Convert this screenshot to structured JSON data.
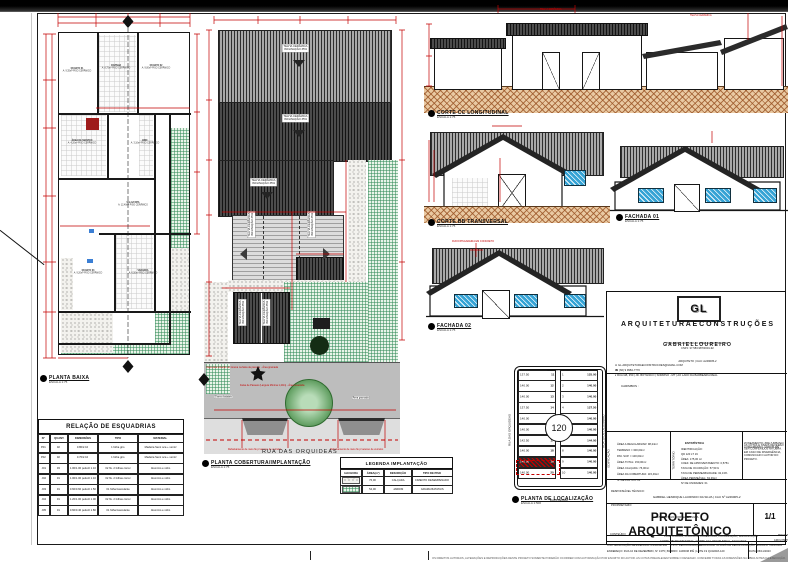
{
  "drawings": {
    "planta_baixa": {
      "label": "PLANTA BAIXA",
      "scale": "ESCALA  1:75"
    },
    "planta_cobertura": {
      "label": "PLANTA COBERTURA/IMPLANTAÇÃO",
      "scale": "ESCALA  1:75"
    },
    "planta_localizacao": {
      "label": "PLANTA DE LOCALIZAÇÃO",
      "scale": "ESCALA  1:500"
    },
    "corte_cc": {
      "label": "CORTE CC LONGITUDINAL",
      "scale": "ESCALA  1:75"
    },
    "corte_bb": {
      "label": "CORTE BB TRANSVERSAL",
      "scale": "ESCALA  1:75"
    },
    "fachada_01": {
      "label": "FACHADA 01",
      "scale": "ESCALA  1:75"
    },
    "fachada_02": {
      "label": "FACHADA 02",
      "scale": "ESCALA  1:75"
    }
  },
  "floor_plan": {
    "rooms": [
      {
        "name": "QUARTO 01",
        "info": "A: 9,35m² PISO CERÂMICO"
      },
      {
        "name": "COZINHA",
        "info": "A: 8,75m² PISO CERÂMICO"
      },
      {
        "name": "QUARTO 02",
        "info": "A: 9,00m² PISO CERÂMICO"
      },
      {
        "name": "ÁREA DE SERVIÇO",
        "info": "A: 4,20m² PISO CERÂMICO"
      },
      {
        "name": "BWC",
        "info": "A: 3,10m² PISO CERÂMICO"
      },
      {
        "name": "SALA/COPA",
        "info": "A: 12,40m² PISO CERÂMICO"
      },
      {
        "name": "QUARTO 03",
        "info": "A: 9,20m² PISO CERÂMICO"
      },
      {
        "name": "VARANDA",
        "info": "A: 6,50m² PISO CERÂMICO"
      }
    ]
  },
  "roof": {
    "tile_note": "TELHA CERÂMICA",
    "slope_note": "INCLINAÇÃO 35%"
  },
  "sections": {
    "rufo_note": "RUFO/PINGADEIRA EM CONCRETO"
  },
  "implantacao": {
    "street": "RUA DAS ORQUIDEAS",
    "notes": [
      "Vaga para locação de Grama na faixa de passeio - Área gramada",
      "Faixa de Passeio (Largura Mínima 1,20m) - Área revestida",
      "Grama batatais",
      "Rebaixamento de meio fio p/ acesso de veículos",
      "Rebaixamento de meio fio p/ acesso de veículos",
      "Área gramada"
    ]
  },
  "esquadrias": {
    "title": "RELAÇÃO DE ESQUADRIAS",
    "headers": [
      "Nº",
      "QUANT.",
      "DIMENSÕES",
      "TIPO",
      "MATERIAL"
    ],
    "rows": [
      [
        "P01",
        "02",
        "0.80/2.10",
        "1 folha giro",
        "Madeira Semi oca + verniz"
      ],
      [
        "P02",
        "02",
        "0.70/2.10",
        "1 folha giro",
        "Madeira Semi oca + verniz"
      ],
      [
        "J01",
        "03",
        "1.00/1.00 peitoril 1.10",
        "02 fls. 2 folhas correr",
        "Alumínio e vidro"
      ],
      [
        "J02",
        "01",
        "1.00/1.00 peitoril 1.10",
        "02 fls. 2 folhas correr",
        "Alumínio e vidro"
      ],
      [
        "J03",
        "01",
        "0.60/0.60 peitoril 1.50",
        "01 folha basculante",
        "Alumínio e vidro"
      ],
      [
        "J04",
        "01",
        "1.20/1.00 peitoril 1.00",
        "02 fls. 2 folhas correr",
        "Alumínio e vidro"
      ],
      [
        "J05",
        "01",
        "0.60/0.40 peitoril 1.80",
        "01 folha basculante",
        "Alumínio e vidro"
      ]
    ]
  },
  "legenda": {
    "title": "LEGENDA IMPLANTAÇÃO",
    "headers": [
      "HACHURA",
      "ÁREA(m²)",
      "DESCRIÇÃO",
      "TIPO DE PISO"
    ],
    "rows": [
      {
        "swatch": "speckle",
        "area": "76,00",
        "desc": "CALÇADA",
        "piso": "CIMENTO DESEMPENADO"
      },
      {
        "swatch": "grass",
        "area": "54,00",
        "desc": "JARDIM",
        "piso": "GRAMA BATATAIS"
      }
    ]
  },
  "localizacao": {
    "streets": {
      "top": "RUA MATRINCHA",
      "bottom": "RUA PIAPARA",
      "left": "RUA DAS ORQUIDEAS",
      "right": "RUA 10 DE DEZEMBRO"
    },
    "quadra": "120",
    "highlight_lot": "19",
    "left_lots": [
      {
        "area": "137.50",
        "n": "11"
      },
      {
        "area": "140.00",
        "n": "12"
      },
      {
        "area": "140.00",
        "n": "13"
      },
      {
        "area": "137.50",
        "n": "14"
      },
      {
        "area": "140.00",
        "n": "15"
      },
      {
        "area": "140.00",
        "n": "16"
      },
      {
        "area": "142.50",
        "n": "17"
      },
      {
        "area": "140.00",
        "n": "18"
      },
      {
        "area": "140.00",
        "n": "19"
      },
      {
        "area": "140.00",
        "n": "20"
      }
    ],
    "right_lots": [
      {
        "n": "1",
        "area": "125.00"
      },
      {
        "n": "2",
        "area": "140.00"
      },
      {
        "n": "3",
        "area": "140.00"
      },
      {
        "n": "4",
        "area": "127.50"
      },
      {
        "n": "5",
        "area": "140.00"
      },
      {
        "n": "6",
        "area": "140.00"
      },
      {
        "n": "7",
        "area": "144.00"
      },
      {
        "n": "8",
        "area": "140.00"
      },
      {
        "n": "9",
        "area": "140.00"
      },
      {
        "n": "10",
        "area": "140.00"
      }
    ]
  },
  "titleblock": {
    "logo_text": "GL",
    "company": "A R Q U I T E T U R A   E   C O N S T R U Ç Õ E S",
    "slogan": "\"PROJETAR, CONSTRUIR E REALIZAR SONHOS\"",
    "cnpj": "CNPJ: 37.583.987/0001-92",
    "owner_name": "G A B R I E L   L O U R E I R O",
    "owner_role": "ARQUITETO | CAU: A249005-2",
    "email": "GL.ARQUITETURAECONSTRUCOES@GMAIL.COM",
    "phone": "(66) 9 9984-7770",
    "address": "RUA GB, 350 | JD. BOTÂNICO | SORRISO - MT | AO LADO DA BARBEARIA REAL",
    "carimbos": "CARIMBOS :",
    "edificacao_label": "EDIFICAÇÃO",
    "edificacao_lines": [
      "ÁREA A REGULARIZAR: 98,24m²",
      "TERRENO = 300,00m²",
      "PAV. SUP. = 100,00m²",
      "ÁREA TOTAL: 150,00m²",
      "ÁREA CALÇADA: 76,00m²",
      "ÁREA DA COBERTURA: 115,49m²",
      "Nº DE PAVTOS: 01"
    ],
    "estatistica_title": "ESTATÍSTICA",
    "territorio_label": "TERRITÓRIO",
    "territorio_lines": [
      "IDENTIFICAÇÃO:",
      "QD 120 LT 19",
      "ÁREA: 175,00 m²",
      "COEF. DE APROVEITAMENTO: 0,5751",
      "TAXA DE OCUPAÇÃO: 57,51%",
      "TAXA DE PERMEABILIDADE: 32,13%",
      "ÁREA PERMEÁVEL: 63,39m²",
      "Nº DE UNIDADES: 01"
    ],
    "zoneamento": "ZONEAMENTO: ZRE (URBANA)",
    "loteamento": "LOTEAMENTO: JARDIM IPÊ",
    "obs_note": "AS COTAS E NÍVEIS DEVERÃO SER CONFERIDOS NA OBRA. EM CASO DE DIVERGÊNCIA, COMUNICAR O AUTOR DO PROJETO.",
    "resp_label": "RESPONSÁVEL TÉCNICO:",
    "resp_name": "GABRIEL HENRIQUE LAURINDO DA SILVA | CAU Nº A249005-2",
    "prop_label": "PROPRIETÁRIO:",
    "prop_name": "LUIS GUSTAVO CORTEZ DA SILVA",
    "title": "PROJETO ARQUITETÔNICO",
    "folha_label": "FOLHA",
    "folha": "1/1",
    "conteudo_label": "CONTEÚDO:",
    "conteudo_1": "PLANTA BAIXA, PLANTA DE COBERTURA, LOCALIZAÇÃO, IMPLANTAÇÃO",
    "conteudo_2": "CORTE BB TRANSVERSAL, CORTE CC LONGITUDINAL, FACHADAS",
    "prancha_1": "PROJETO: GABRIEL LOUREIRO",
    "prancha_2": "ARQUITETO E URBANISTA",
    "uso": "USO: EDIFICAÇÃO RESIDENCIAL UNIFAMILIAR",
    "tipo": "TIPO: REGULARIZAÇÃO",
    "finalidade": "FINALIDADE: ALVARÁ DE REGULARIZAÇÃO",
    "escala": "ESCALA: INDICADA",
    "endereco": "ENDEREÇO: RUA 10 DE DEZEMBRO, Nº 1375 | BAIRRO: JARDIM IPÊ | LOTE 19 QUADRA 120",
    "data": "DATA: 06/11/2023"
  },
  "disclaimer": "OS DIREITOS AUTORAIS, ALTERAÇÕES E REPRODUÇÕES DESTE PROJETO SOMENTE PODERÃO OCORRER COM AUTORIZAÇÃO POR ESCRITO DO AUTOR. AS COTAS PREVALECEM SOBRE O DESENHO. CONFERIR TODAS AS DIMENSÕES NA OBRA ANTES DA EXECUÇÃO."
}
